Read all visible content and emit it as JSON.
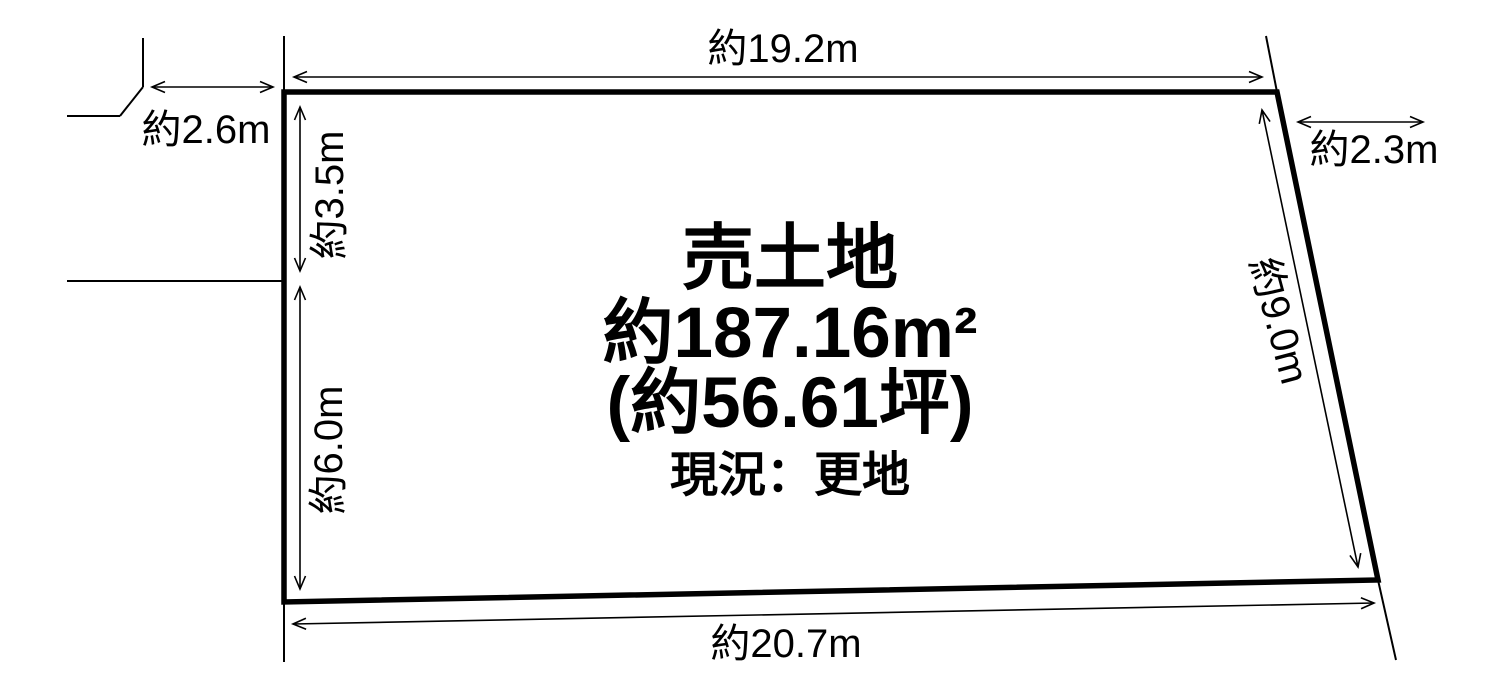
{
  "colors": {
    "background": "#ffffff",
    "line": "#000000",
    "text": "#000000"
  },
  "plot": {
    "title": "売土地",
    "area": "約187.16m²",
    "area_tsubo": "(約56.61坪)",
    "status": "現況：更地"
  },
  "dimensions": {
    "top": "約19.2m",
    "top_left_offset": "約2.6m",
    "left_upper": "約3.5m",
    "left_lower": "約6.0m",
    "top_right_offset": "約2.3m",
    "right": "約9.0m",
    "bottom": "約20.7m"
  }
}
